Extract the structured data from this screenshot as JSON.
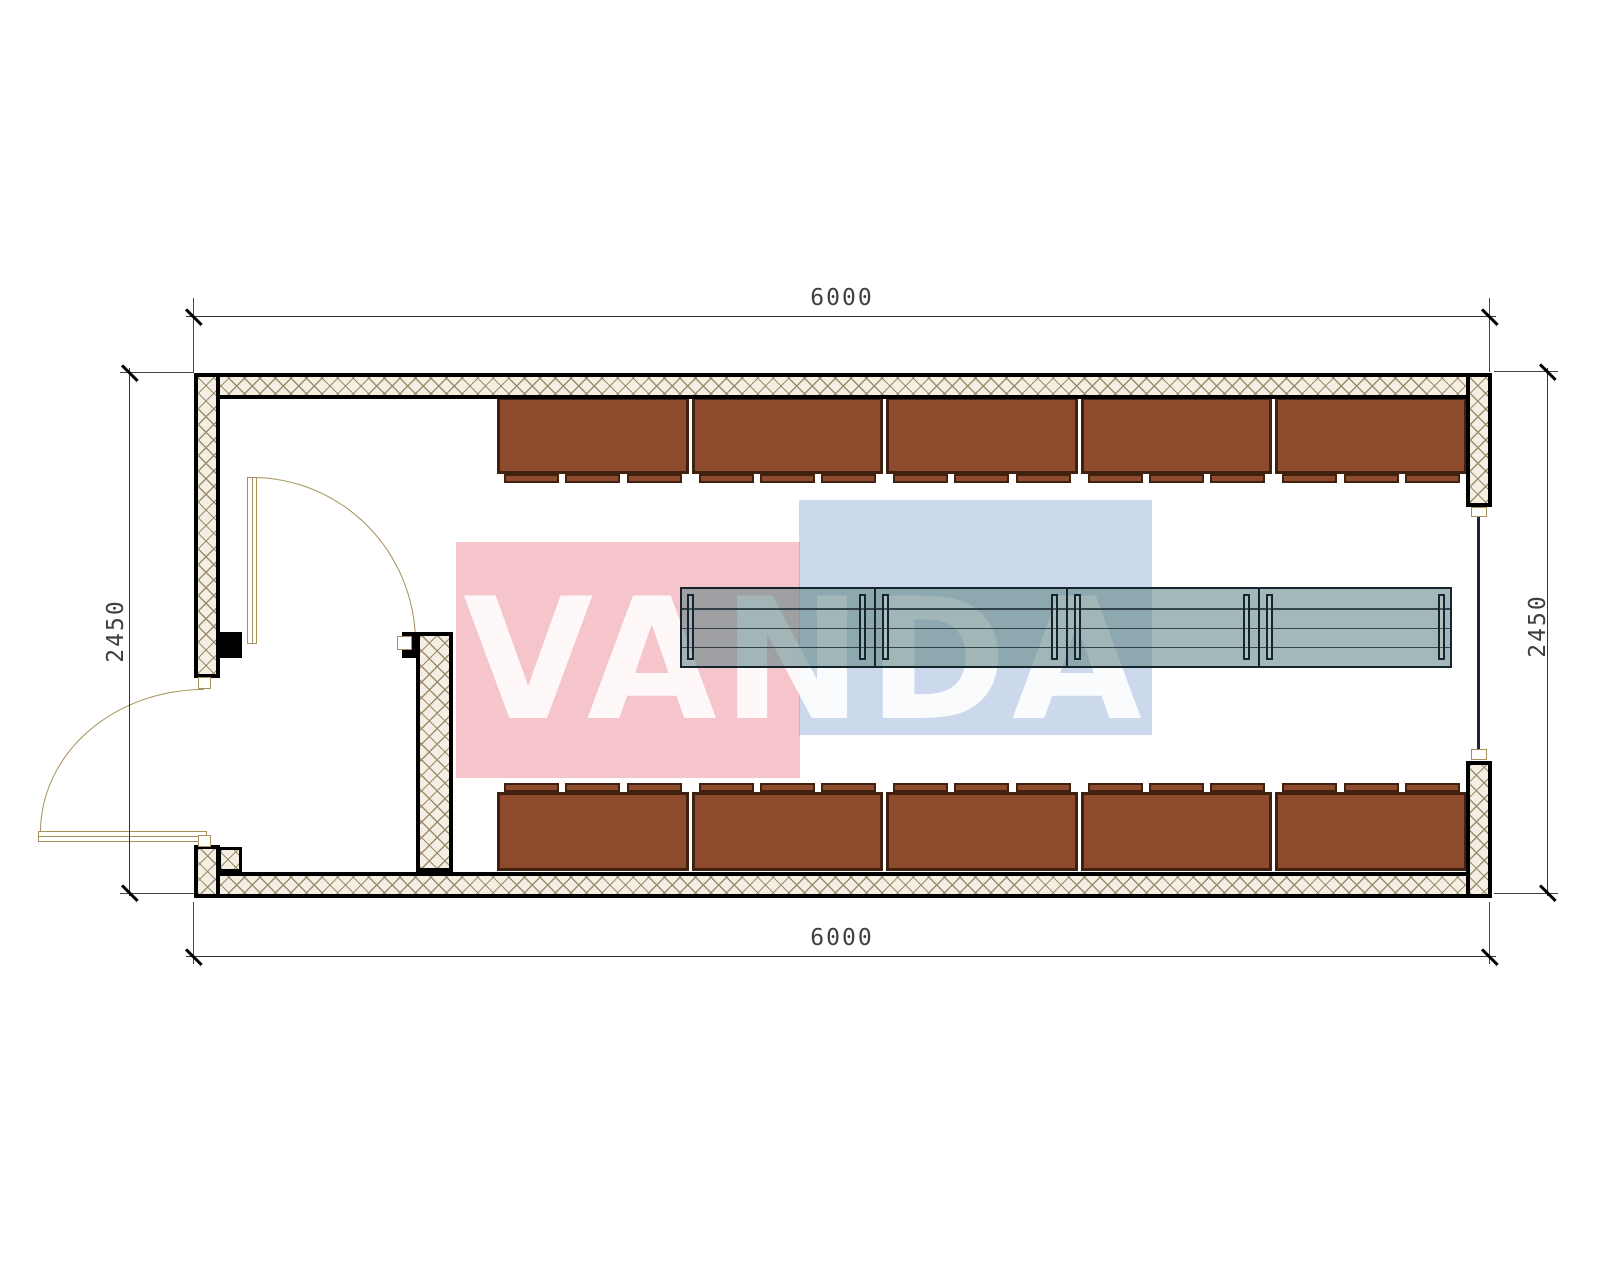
{
  "drawing": {
    "type": "floor-plan",
    "watermark_text": "VANDA",
    "dimensions": {
      "top": "6000",
      "bottom": "6000",
      "left": "2450",
      "right": "2450"
    }
  },
  "colors": {
    "wall_hatch_bg": "#f4efe2",
    "wall_hatch_line": "#9b8c6d",
    "wall_outline": "#000000",
    "locker_fill": "#8d4a2d",
    "locker_border": "#40200f",
    "bench_fill": "#8fadad",
    "bench_outline": "#16242e",
    "door_line": "#a6905c",
    "watermark_pink": "#e23e55",
    "watermark_blue": "#6088c6",
    "watermark_letters": "#ffffff"
  },
  "furniture": {
    "locker_units_top": 5,
    "locker_units_bottom": 5,
    "locker_door_tabs_per_unit": 3,
    "bench_segments": 4,
    "bench_slats": 4
  }
}
